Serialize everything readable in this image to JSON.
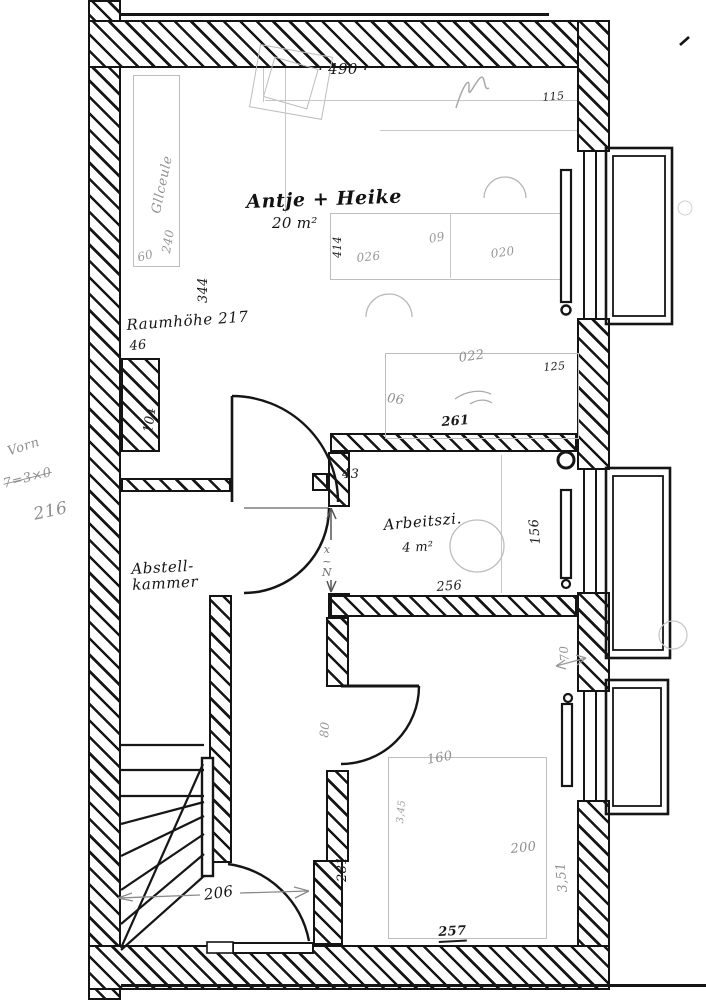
{
  "document": {
    "kind": "hand-drawn floor plan (scan)",
    "colors": {
      "paper": "#ffffff",
      "ink": "#151515",
      "pencil": "#9a9a9a"
    }
  },
  "rooms": [
    {
      "name": "Antje + Heike",
      "area": "20 m²"
    },
    {
      "name": "Abstellkammer"
    },
    {
      "name": "Arbeitszi.",
      "area": "4 m²"
    }
  ],
  "annotations": [
    {
      "name": "dim-490",
      "text": "· 490 ·",
      "x": 318,
      "y": 62,
      "rot": 0,
      "cls": "ink-md"
    },
    {
      "name": "dim-115",
      "text": "115",
      "x": 542,
      "y": 92,
      "rot": -5,
      "cls": "ink-sm"
    },
    {
      "name": "room-antje-name",
      "text": "Antje + Heike",
      "x": 246,
      "y": 192,
      "rot": -2,
      "cls": "ink-lg cursive"
    },
    {
      "name": "room-antje-area",
      "text": "20 m²",
      "x": 272,
      "y": 216,
      "rot": 0,
      "cls": "ink-md"
    },
    {
      "name": "dim-414",
      "text": "414",
      "x": 332,
      "y": 258,
      "rot": -90,
      "cls": "ink-sm"
    },
    {
      "name": "dim-09-bed",
      "text": "09",
      "x": 428,
      "y": 233,
      "rot": -10,
      "cls": "pencil"
    },
    {
      "name": "dim-026-bed",
      "text": "026",
      "x": 356,
      "y": 252,
      "rot": -6,
      "cls": "pencil"
    },
    {
      "name": "dim-020-bed",
      "text": "020",
      "x": 490,
      "y": 248,
      "rot": -8,
      "cls": "pencil"
    },
    {
      "name": "note-band-word",
      "text": "Gllceule",
      "x": 150,
      "y": 212,
      "rot": -78,
      "cls": "pencil-md cursive"
    },
    {
      "name": "note-band-240",
      "text": "240",
      "x": 160,
      "y": 252,
      "rot": -80,
      "cls": "pencil"
    },
    {
      "name": "dim-60-band",
      "text": "60",
      "x": 136,
      "y": 252,
      "rot": -15,
      "cls": "pencil"
    },
    {
      "name": "dim-344",
      "text": "344",
      "x": 197,
      "y": 303,
      "rot": -90,
      "cls": "ink"
    },
    {
      "name": "note-raumhoehe",
      "text": "Raumhöhe 217",
      "x": 126,
      "y": 318,
      "rot": -4,
      "cls": "ink-md cursive"
    },
    {
      "name": "dim-46",
      "text": "46",
      "x": 129,
      "y": 340,
      "rot": -5,
      "cls": "ink"
    },
    {
      "name": "dim-104",
      "text": "104",
      "x": 142,
      "y": 432,
      "rot": -82,
      "cls": "ink"
    },
    {
      "name": "dim-022",
      "text": "022",
      "x": 458,
      "y": 352,
      "rot": -8,
      "cls": "pencil-md"
    },
    {
      "name": "dim-125",
      "text": "125",
      "x": 543,
      "y": 362,
      "rot": -5,
      "cls": "ink-sm"
    },
    {
      "name": "dim-06",
      "text": "06",
      "x": 388,
      "y": 392,
      "rot": 8,
      "cls": "pencil-md"
    },
    {
      "name": "dim-261",
      "text": "261",
      "x": 441,
      "y": 416,
      "rot": -4,
      "cls": "ink strong"
    },
    {
      "name": "dim-43",
      "text": "43",
      "x": 342,
      "y": 468,
      "rot": 0,
      "cls": "ink"
    },
    {
      "name": "room-abstell",
      "text": "Abstell-\nkammer",
      "x": 131,
      "y": 562,
      "rot": -3,
      "cls": "ink-md cursive"
    },
    {
      "name": "note-vorn-1",
      "text": "Vorn",
      "x": 6,
      "y": 446,
      "rot": -18,
      "cls": "pencil-md cursive"
    },
    {
      "name": "note-vorn-2",
      "text": "7=3×0",
      "x": 2,
      "y": 478,
      "rot": -14,
      "cls": "pencil-md cursive strike"
    },
    {
      "name": "note-vorn-3",
      "text": "216",
      "x": 32,
      "y": 506,
      "rot": -12,
      "cls": "pencil-lg cursive"
    },
    {
      "name": "note-x-n",
      "text": "x\n~\nN",
      "x": 322,
      "y": 544,
      "rot": 0,
      "cls": "pencil-dk"
    },
    {
      "name": "room-arbeit-name",
      "text": "Arbeitszi.",
      "x": 383,
      "y": 518,
      "rot": -5,
      "cls": "ink-md cursive"
    },
    {
      "name": "room-arbeit-area",
      "text": "4 m²",
      "x": 402,
      "y": 542,
      "rot": -3,
      "cls": "ink"
    },
    {
      "name": "dim-156",
      "text": "156",
      "x": 530,
      "y": 545,
      "rot": -95,
      "cls": "ink"
    },
    {
      "name": "dim-256",
      "text": "256",
      "x": 436,
      "y": 581,
      "rot": -4,
      "cls": "ink"
    },
    {
      "name": "dim-70",
      "text": "70",
      "x": 559,
      "y": 662,
      "rot": -95,
      "cls": "pencil"
    },
    {
      "name": "dim-80",
      "text": "80",
      "x": 318,
      "y": 737,
      "rot": -85,
      "cls": "pencil"
    },
    {
      "name": "dim-160",
      "text": "160",
      "x": 426,
      "y": 754,
      "rot": -10,
      "cls": "pencil-md"
    },
    {
      "name": "dim-345",
      "text": "3,45",
      "x": 396,
      "y": 823,
      "rot": -85,
      "cls": "pencil-sm"
    },
    {
      "name": "dim-200",
      "text": "200",
      "x": 510,
      "y": 843,
      "rot": -6,
      "cls": "pencil-md"
    },
    {
      "name": "dim-281",
      "text": "281",
      "x": 336,
      "y": 882,
      "rot": -90,
      "cls": "ink"
    },
    {
      "name": "dim-351",
      "text": "3,51",
      "x": 557,
      "y": 893,
      "rot": -95,
      "cls": "pencil-md"
    },
    {
      "name": "dim-206",
      "text": "206",
      "x": 203,
      "y": 888,
      "rot": -8,
      "cls": "ink-md"
    },
    {
      "name": "dim-257",
      "text": "257",
      "x": 438,
      "y": 926,
      "rot": -3,
      "cls": "ink strong underline"
    }
  ]
}
